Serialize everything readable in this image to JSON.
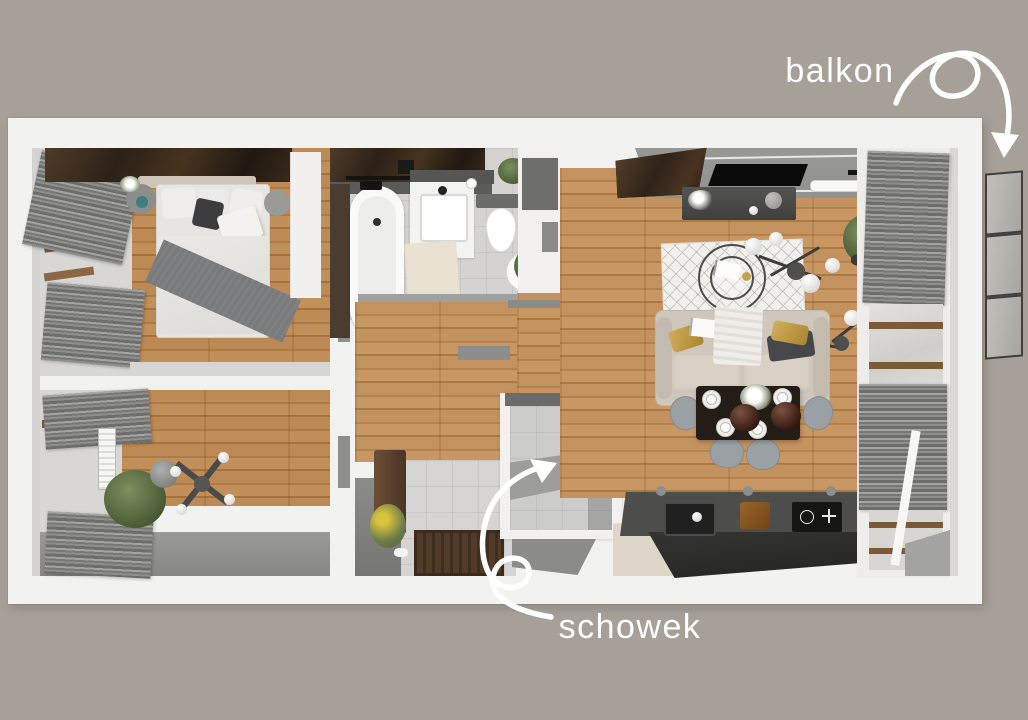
{
  "annotations": {
    "balkon_label": "balkon",
    "schowek_label": "schowek"
  },
  "palette": {
    "bg": "#a7a099",
    "plan": "#f2f2f0",
    "wood": "#c0905a",
    "tile": "#d4d3d1",
    "curtain": "#8a8a88",
    "wall-gray": "#8f8f8d",
    "counter-top": "#4d4d4b",
    "counter-front": "#2c2c2a",
    "sofa": "#cfc7bc",
    "gold": "#c09a43",
    "rug": "#f1f0ed",
    "accent-dark-wood": "#36291f",
    "plant": "#5d6f45",
    "annotation": "#ffffff"
  }
}
